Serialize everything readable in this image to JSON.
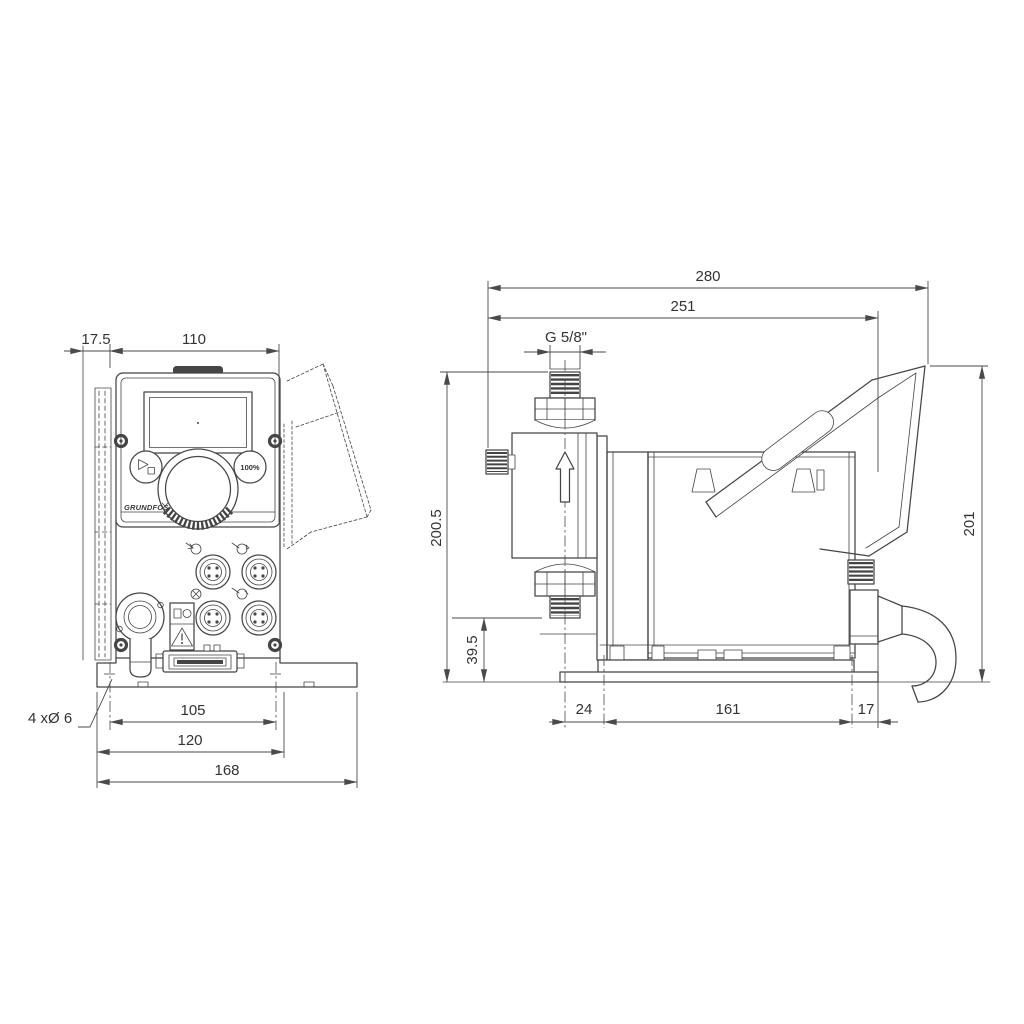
{
  "drawing_type": "dimensional technical drawing, dosing pump, two views",
  "colors": {
    "background": "#ffffff",
    "line": "#454545",
    "text": "#333333"
  },
  "front": {
    "dim_offset": "17.5",
    "dim_width": "110",
    "dim_hole_pitch": "105",
    "dim_plate": "120",
    "dim_base": "168",
    "note_holes": "4 xØ 6",
    "btn_100": "100%",
    "logo": "GRUNDFOS"
  },
  "side": {
    "dim_total": "280",
    "dim_body": "251",
    "thread": "G 5/8\"",
    "dim_height": "200.5",
    "dim_valve": "39.5",
    "dim_cover": "201",
    "dim_front": "24",
    "dim_plate": "161",
    "dim_rear": "17"
  }
}
